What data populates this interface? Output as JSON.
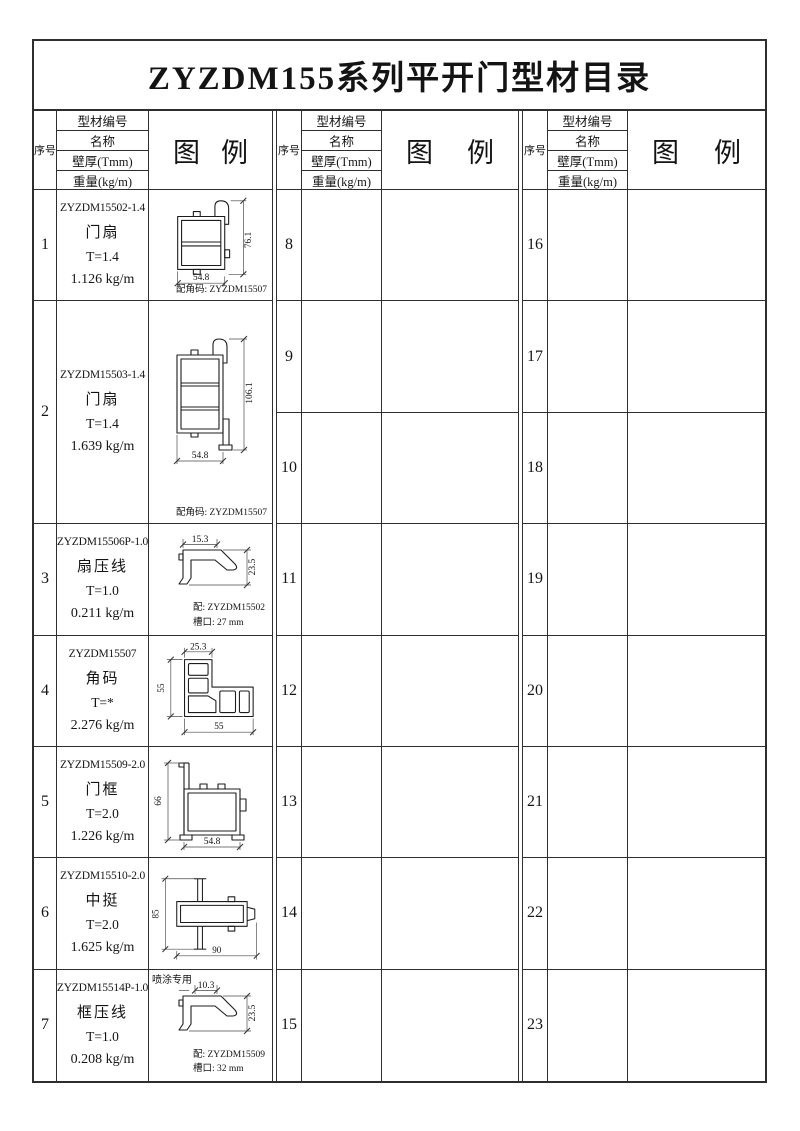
{
  "title": "ZYZDM155系列平开门型材目录",
  "header": {
    "seq": "序号",
    "info_rows": [
      "型材编号",
      "名称",
      "壁厚(Tmm)",
      "重量(kg/m)"
    ],
    "legend_left": "图",
    "legend_right": "例"
  },
  "left_rows": [
    {
      "seq": "1",
      "code": "ZYZDM15502-1.4",
      "name": "门扇",
      "thickness": "T=1.4",
      "weight": "1.126 kg/m",
      "dim_h": "76.1",
      "dim_w": "54.8",
      "note": "配角码: ZYZDM15507"
    },
    {
      "seq": "2",
      "code": "ZYZDM15503-1.4",
      "name": "门扇",
      "thickness": "T=1.4",
      "weight": "1.639 kg/m",
      "dim_h": "106.1",
      "dim_w": "54.8",
      "note": "配角码: ZYZDM15507"
    },
    {
      "seq": "3",
      "code": "ZYZDM15506P-1.0",
      "name": "扇压线",
      "thickness": "T=1.0",
      "weight": "0.211 kg/m",
      "dim_top": "15.3",
      "dim_right": "23.5",
      "note1": "配: ZYZDM15502",
      "note2": "槽口: 27 mm"
    },
    {
      "seq": "4",
      "code": "ZYZDM15507",
      "name": "角码",
      "thickness": "T=*",
      "weight": "2.276 kg/m",
      "dim_top": "25.3",
      "dim_left": "55",
      "dim_bottom": "55"
    },
    {
      "seq": "5",
      "code": "ZYZDM15509-2.0",
      "name": "门框",
      "thickness": "T=2.0",
      "weight": "1.226 kg/m",
      "dim_left": "66",
      "dim_bottom": "54.8"
    },
    {
      "seq": "6",
      "code": "ZYZDM15510-2.0",
      "name": "中挺",
      "thickness": "T=2.0",
      "weight": "1.625 kg/m",
      "dim_left": "85",
      "dim_bottom": "90",
      "note": "喷涂专用"
    },
    {
      "seq": "7",
      "code": "ZYZDM15514P-1.0",
      "name": "框压线",
      "thickness": "T=1.0",
      "weight": "0.208 kg/m",
      "dim_top": "10.3",
      "dim_right": "23.5",
      "note1": "配: ZYZDM15509",
      "note2": "槽口: 32 mm"
    }
  ],
  "middle_seqs": [
    "8",
    "9",
    "10",
    "11",
    "12",
    "13",
    "14",
    "15"
  ],
  "right_seqs": [
    "16",
    "17",
    "18",
    "19",
    "20",
    "21",
    "22",
    "23"
  ]
}
